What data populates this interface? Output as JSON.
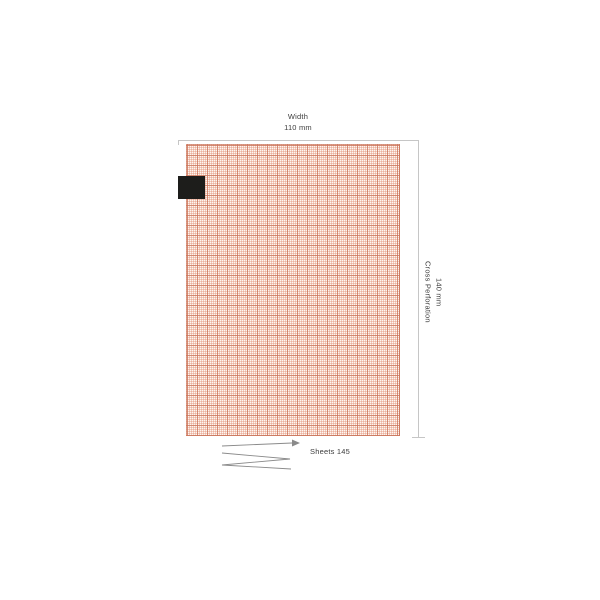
{
  "diagram": {
    "title_context": "ECG chart paper dimension diagram",
    "width_dimension": {
      "line1": "Width",
      "line2": "110 mm"
    },
    "cross_perforation_dimension": {
      "line1": "Cross Perforation",
      "line2": "140 mm"
    },
    "sheets_label": "Sheets  145"
  },
  "colors": {
    "grid_bg": "#fdf6f1",
    "grid_fine": "rgba(226,141,113,0.40)",
    "grid_bold": "rgba(203,118,92,0.75)",
    "grid_edge": "rgba(203,118,92,0.70)",
    "black_mark": "#1d1d1b",
    "dim_line": "#c6c6c6",
    "fold_line": "#8a8a8a",
    "text": "#3d3d3d"
  }
}
